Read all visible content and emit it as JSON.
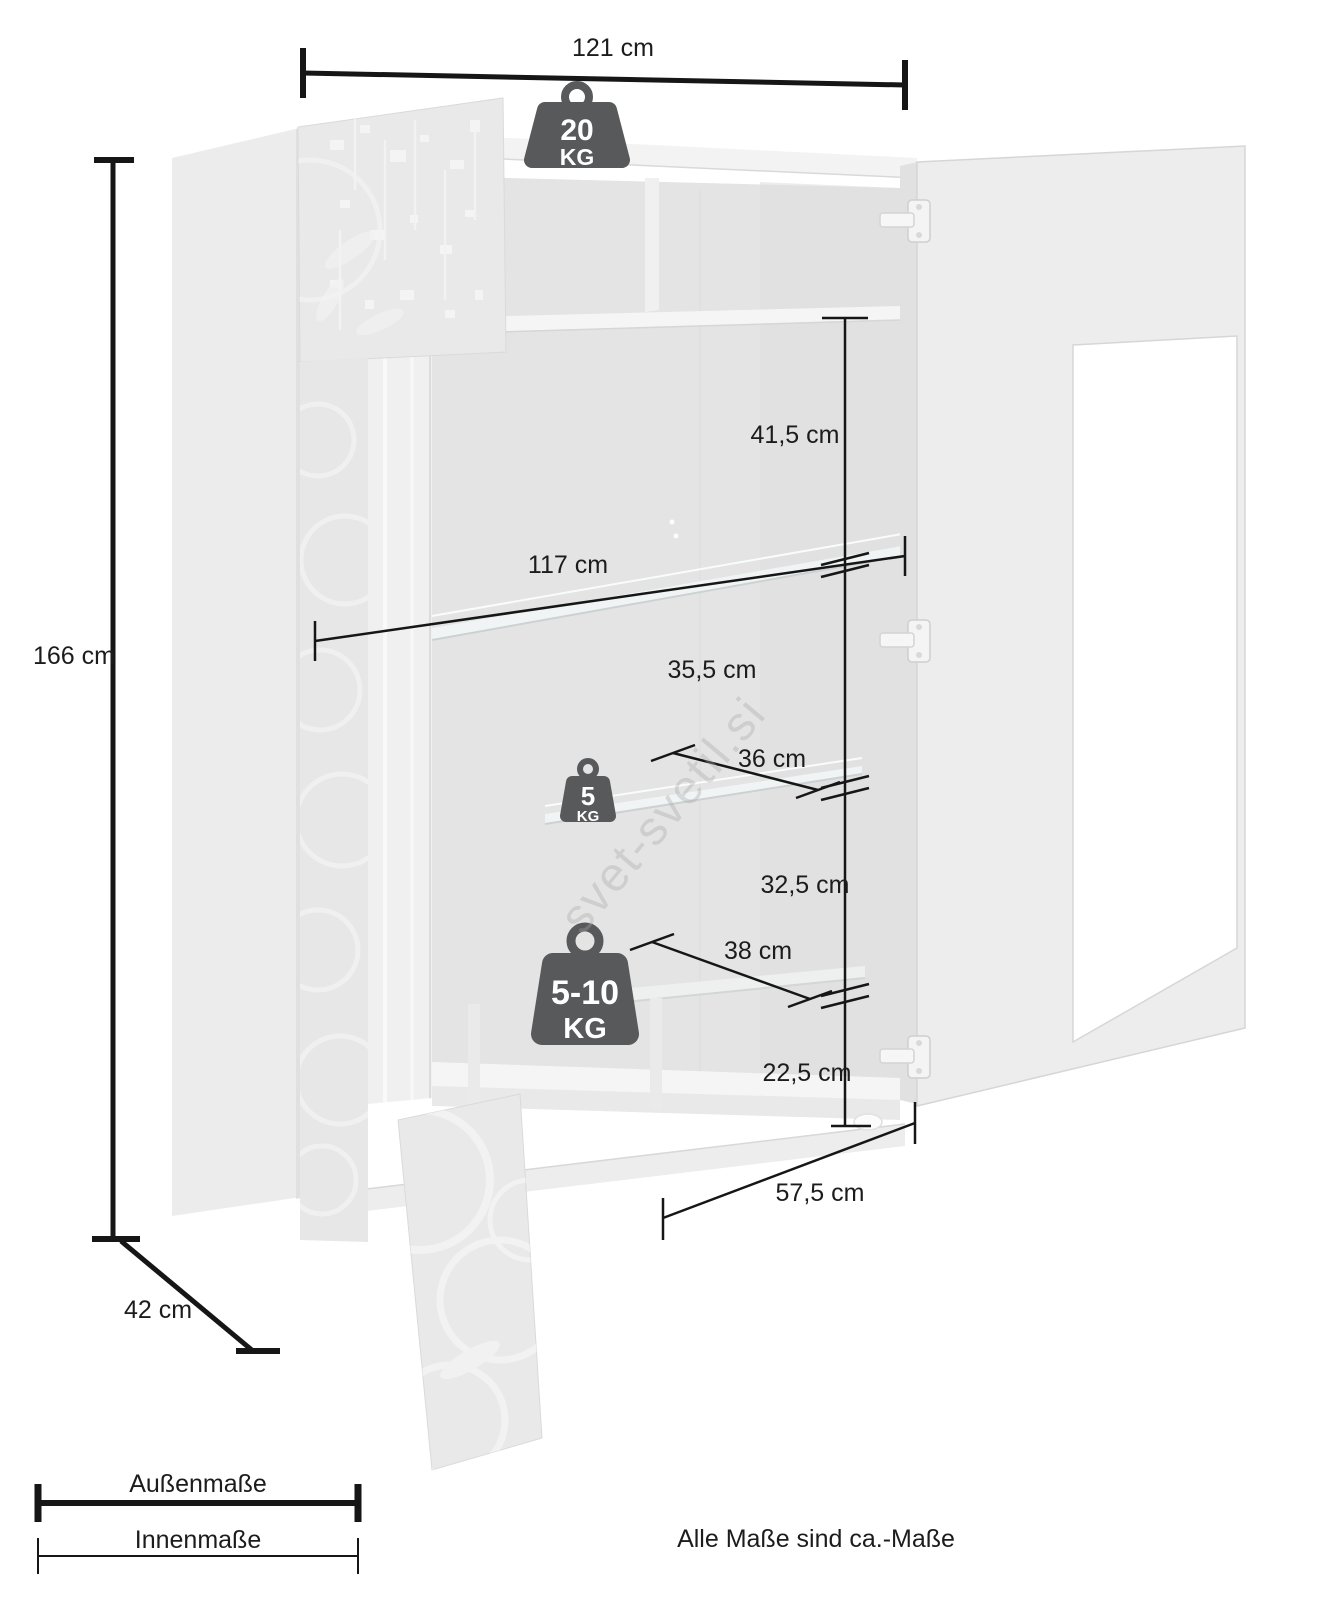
{
  "diagram": {
    "outer_dimensions": {
      "width": {
        "label": "121 cm",
        "value_cm": 121
      },
      "height": {
        "label": "166 cm",
        "value_cm": 166
      },
      "depth": {
        "label": "42 cm",
        "value_cm": 42
      }
    },
    "inner_dimensions": {
      "top_section_height": {
        "label": "41,5 cm",
        "value_cm": 41.5
      },
      "inner_width": {
        "label": "117 cm",
        "value_cm": 117
      },
      "upper_shelf_gap": {
        "label": "35,5 cm",
        "value_cm": 35.5
      },
      "glass_shelf_depth": {
        "label": "36 cm",
        "value_cm": 36
      },
      "middle_shelf_gap": {
        "label": "32,5 cm",
        "value_cm": 32.5
      },
      "lower_shelf_depth": {
        "label": "38 cm",
        "value_cm": 38
      },
      "bottom_section_height": {
        "label": "22,5 cm",
        "value_cm": 22.5
      },
      "bottom_inner_width": {
        "label": "57,5 cm",
        "value_cm": 57.5
      }
    },
    "load_capacities": {
      "top_panel": {
        "value": "20",
        "unit": "KG"
      },
      "glass_shelf": {
        "value": "5",
        "unit": "KG"
      },
      "lower_shelf": {
        "value": "5-10",
        "unit": "KG"
      }
    },
    "legend": {
      "outer_label": "Außenmaße",
      "inner_label": "Innenmaße"
    },
    "footnote": "Alle Maße sind ca.-Maße",
    "watermark": "svet-svetil.si",
    "colors": {
      "dimension_line": "#161616",
      "weight_badge": "#58595b",
      "cabinet_light": "#ededed",
      "cabinet_shadow": "#e0e0e0"
    }
  }
}
